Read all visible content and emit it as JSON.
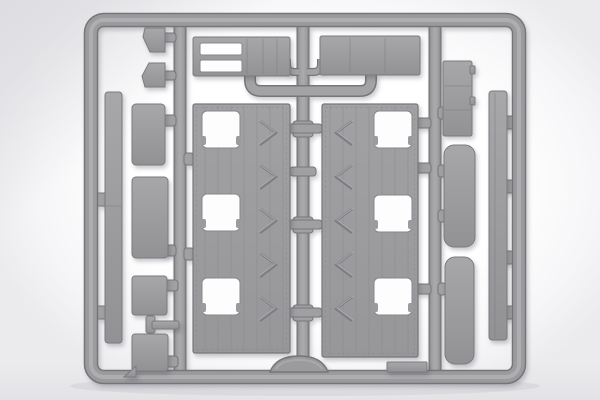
{
  "scene": {
    "type": "product-photo",
    "description": "Gray injection-molded plastic sprue (parts runner frame) from a scale model kit, photographed flat on a white studio background",
    "text_visible": "none",
    "palette": {
      "background": "#ffffff",
      "background_vignette": "#e9e9ec",
      "plastic_mid_gray": "#9b9b9e",
      "plastic_light_edge": "#aaaaac",
      "plastic_dark_edge": "#77777b",
      "cutout_white": "#fdfdfe",
      "shadow": "rgba(75,75,85,0.30)"
    }
  },
  "sprue": {
    "frame": "rounded rectangular outer runner with a small arched hump at bottom center",
    "runners": [
      "left vertical inner runner",
      "center vertical inner runner with cross-gates",
      "right vertical inner runner",
      "upper horizontal runner with upturned ends"
    ],
    "parts": [
      {
        "id": "floor-panel-left",
        "desc": "large planked panel, three square hatch cutouts on left, chevron tread marks on right"
      },
      {
        "id": "floor-panel-right",
        "desc": "large planked panel, three square hatch cutouts on right, chevron tread marks on left"
      },
      {
        "id": "long-strip-left",
        "desc": "long narrow vertical strip with mid seam"
      },
      {
        "id": "stacked-rect-a",
        "desc": "rectangular plate"
      },
      {
        "id": "stacked-rect-b",
        "desc": "rectangular plate"
      },
      {
        "id": "stacked-rect-c",
        "desc": "small square plate"
      },
      {
        "id": "stacked-rect-d",
        "desc": "small square plate"
      },
      {
        "id": "t-shaped-part",
        "desc": "small T-shaped bracket"
      },
      {
        "id": "wedge-upper",
        "desc": "small angled wedge plate"
      },
      {
        "id": "wedge-lower",
        "desc": "small angled wedge plate (mirrored)"
      },
      {
        "id": "ladder-frame-part",
        "desc": "horizontal frame piece with two slot openings"
      },
      {
        "id": "deck-part-top-right",
        "desc": "horizontal slatted deck plate"
      },
      {
        "id": "louvered-box",
        "desc": "small box with horizontal louver lines"
      },
      {
        "id": "rounded-pad-upper",
        "desc": "rounded-end cushion strip"
      },
      {
        "id": "rounded-pad-lower",
        "desc": "rounded-end cushion strip"
      },
      {
        "id": "long-bar-right",
        "desc": "long narrow vertical bar"
      },
      {
        "id": "thin-strip-bottom",
        "desc": "small flat strip on bottom runner"
      },
      {
        "id": "triangle-gusset",
        "desc": "tiny triangular part at bottom left"
      }
    ]
  }
}
